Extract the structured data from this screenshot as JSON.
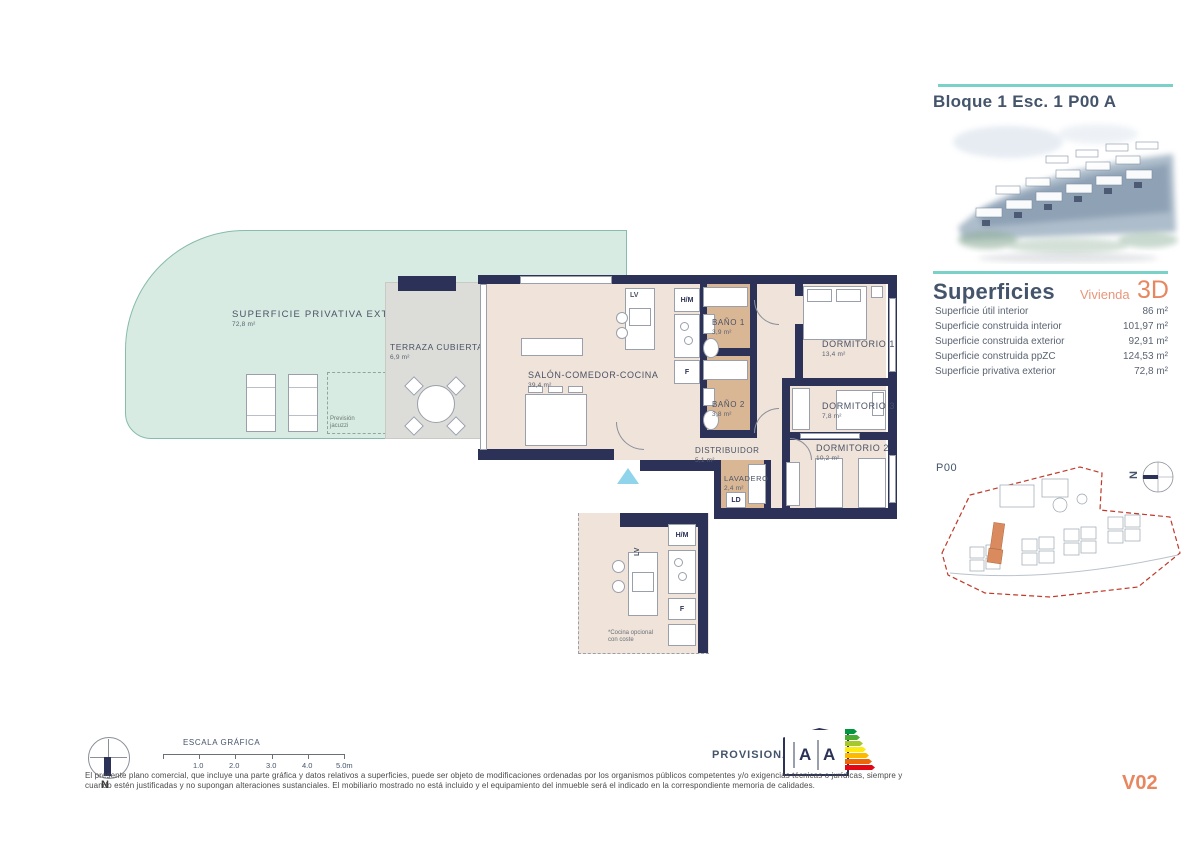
{
  "sidebar": {
    "title": "Bloque 1 Esc. 1 P00 A",
    "superficies": {
      "heading": "Superficies",
      "subheading": "Vivienda",
      "unit_code": "3D",
      "rows": [
        {
          "label": "Superficie útil interior",
          "value": "86 m²"
        },
        {
          "label": "Superficie construida interior",
          "value": "101,97 m²"
        },
        {
          "label": "Superficie construida exterior",
          "value": "92,91 m²"
        },
        {
          "label": "Superficie construida ppZC",
          "value": "124,53 m²"
        },
        {
          "label": "Superficie privativa exterior",
          "value": "72,8 m²"
        }
      ]
    },
    "siteplan": {
      "label": "P00",
      "north_label": "N"
    }
  },
  "floorplan": {
    "rooms": [
      {
        "name": "SUPERFICIE PRIVATIVA EXTERIOR",
        "area": "72,8 m²"
      },
      {
        "name": "TERRAZA CUBIERTA",
        "area": "6,9 m²"
      },
      {
        "name": "SALÓN-COMEDOR-COCINA",
        "area": "39,4 m²"
      },
      {
        "name": "BAÑO 1",
        "area": "3,9 m²"
      },
      {
        "name": "BAÑO 2",
        "area": "3,8 m²"
      },
      {
        "name": "DORMITORIO 1",
        "area": "13,4 m²"
      },
      {
        "name": "DORMITORIO 3",
        "area": "7,8 m²"
      },
      {
        "name": "DORMITORIO 2",
        "area": "10,2 m²"
      },
      {
        "name": "DISTRIBUIDOR",
        "area": "5,1 m²"
      },
      {
        "name": "LAVADERO",
        "area": "2,4 m²"
      }
    ],
    "appliances": {
      "lv": "LV",
      "hm": "H/M",
      "f": "F",
      "ld": "LD"
    },
    "jacuzzi_note_line1": "Previsión",
    "jacuzzi_note_line2": "jacuzzi",
    "kitchen_note_line1": "*Cocina opcional",
    "kitchen_note_line2": "con coste"
  },
  "footer": {
    "scale": {
      "title": "ESCALA GRÁFICA",
      "ticks": [
        "1.0",
        "2.0",
        "3.0",
        "4.0",
        "5.0m"
      ]
    },
    "provisional_label": "PROVISIONAL",
    "energy": {
      "letters": [
        "A",
        "A"
      ]
    },
    "north_label": "N",
    "disclaimer_line1": "El presente plano comercial, que incluye una parte gráfica y datos relativos a superficies, puede ser objeto de modificaciones ordenadas por los organismos públicos competentes y/o exigencias técnicas o jurídicas, siempre y",
    "disclaimer_line2": "cuando estén justificadas y no supongan alteraciones sustanciales. El mobiliario mostrado no está incluido y el equipamiento del inmueble será el indicado en la correspondiente memoria de calidades.",
    "version": "V02"
  },
  "colors": {
    "wall_navy": "#2b3157",
    "mint": "#d8ebe2",
    "tan": "#d9b795",
    "beige": "#efe3da",
    "teal_accent": "#79d1c7",
    "slate": "#44546b",
    "orange": "#e8875f",
    "marker_blue": "#8fd4ea",
    "energy_scale": [
      "#00963f",
      "#4cab33",
      "#a5c92b",
      "#fdea11",
      "#fbba00",
      "#ec6708",
      "#e30613"
    ],
    "site_boundary_red": "#c0392b"
  }
}
